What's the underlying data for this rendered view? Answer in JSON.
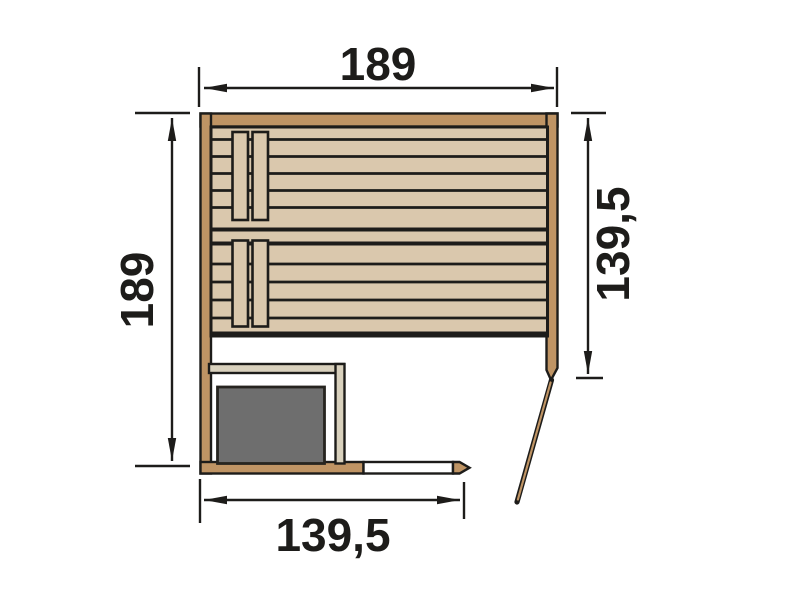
{
  "diagram": {
    "kind": "sauna-floor-plan-top-view",
    "dimensions": {
      "top_width": "189",
      "left_depth": "189",
      "right_inner_depth": "139,5",
      "bottom_inner_width": "139,5"
    }
  },
  "colors": {
    "wall": "#bf9464",
    "plank": "#dac8ad",
    "outline": "#1d1c1a",
    "heater": "#6e6e6e",
    "guard": "#d9d1bd",
    "glass": "#ffffff",
    "floor": "#ffffff"
  }
}
